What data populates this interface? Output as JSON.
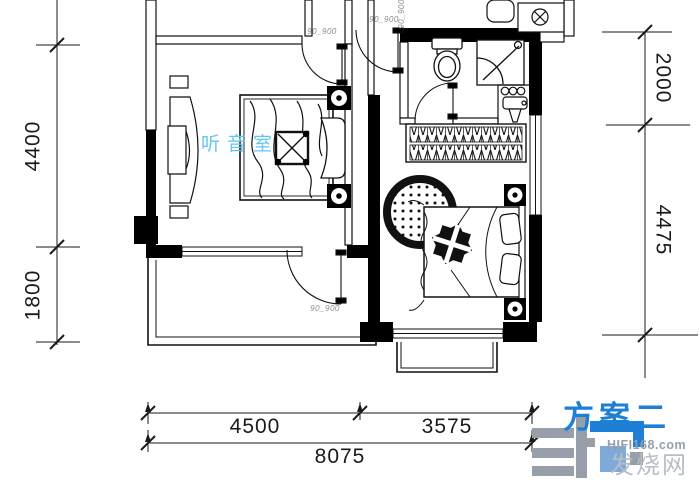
{
  "plan": {
    "room_label": "听音室",
    "door_size_label": "90_900",
    "colors": {
      "room_label_blue": "#63C6F0",
      "line": "#111111"
    }
  },
  "dimensions": {
    "left": [
      {
        "value": "4400"
      },
      {
        "value": "1800"
      }
    ],
    "right": [
      {
        "value": "2000"
      },
      {
        "value": "4475"
      }
    ],
    "bottom_segments": [
      {
        "value": "4500"
      },
      {
        "value": "3575"
      }
    ],
    "bottom_total": {
      "value": "8075"
    }
  },
  "branding": {
    "plan_title": "方案二",
    "site_domain": "HIFI168.com",
    "site_name": "发烧网",
    "colors": {
      "accent": "#1E7FD6",
      "mark_light": "#7FA9D9",
      "gray": "#97A0AA",
      "name_gray": "#B8BEC5"
    }
  }
}
